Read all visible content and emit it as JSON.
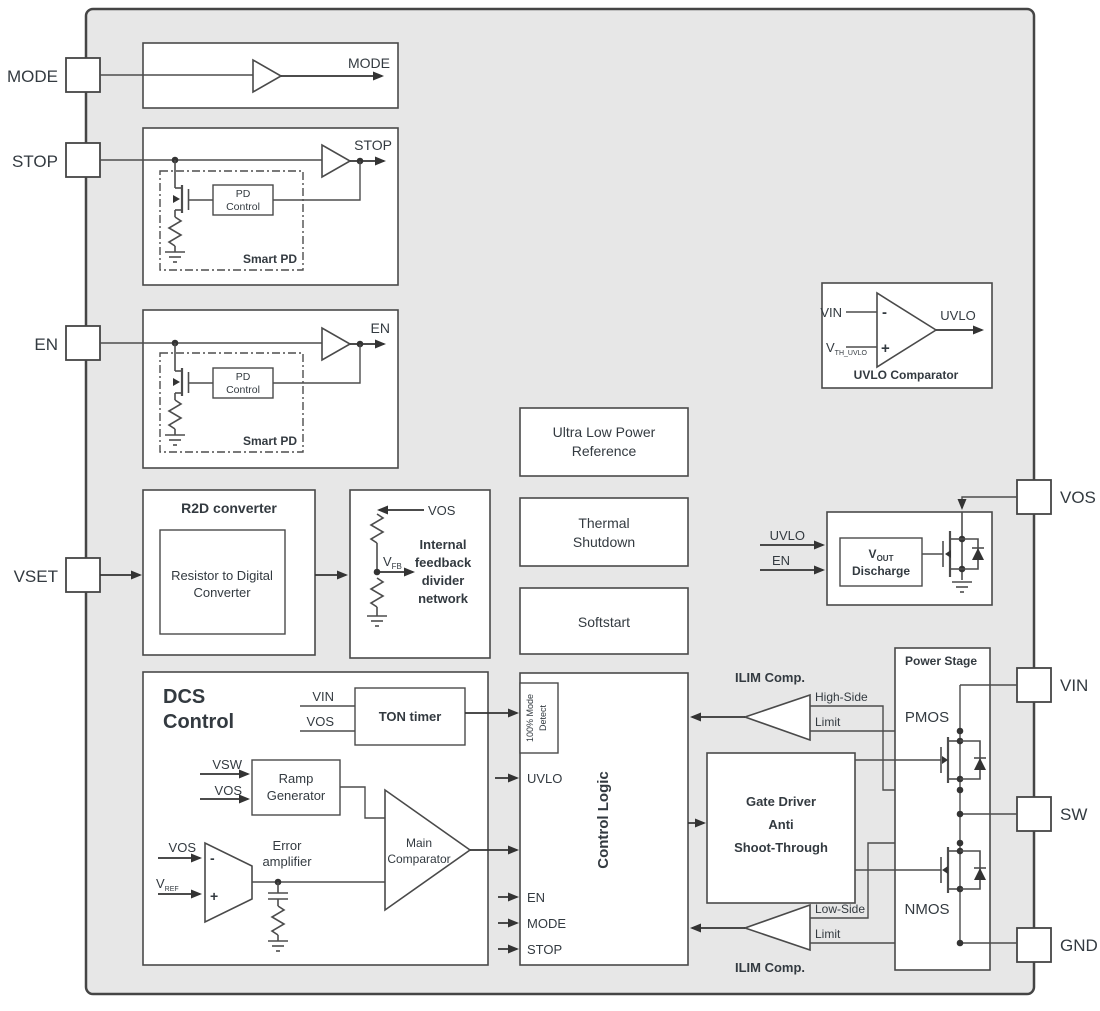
{
  "colors": {
    "chip_background": "#e7e7e7",
    "block_fill": "#ffffff",
    "line": "#4a4a4a",
    "text": "#333a40"
  },
  "pins": {
    "left": [
      "MODE",
      "STOP",
      "EN",
      "VSET"
    ],
    "right": [
      "VOS",
      "VIN",
      "SW",
      "GND"
    ]
  },
  "mode_block": {
    "output_label": "MODE"
  },
  "stop_block": {
    "output_label": "STOP",
    "pd_control_lines": [
      "PD",
      "Control"
    ],
    "smart_pd_label": "Smart PD"
  },
  "en_block": {
    "output_label": "EN",
    "pd_control_lines": [
      "PD",
      "Control"
    ],
    "smart_pd_label": "Smart PD"
  },
  "r2d_block": {
    "title": "R2D converter",
    "inner_lines": [
      "Resistor to Digital",
      "Converter"
    ]
  },
  "feedback_block": {
    "vos_label": "VOS",
    "vfb_base": "V",
    "vfb_sub": "FB",
    "label_lines": [
      "Internal",
      "feedback",
      "divider",
      "network"
    ]
  },
  "reference_block": {
    "lines": [
      "Ultra Low Power",
      "Reference"
    ]
  },
  "thermal_block": {
    "lines": [
      "Thermal",
      "Shutdown"
    ]
  },
  "softstart_block": {
    "label": "Softstart"
  },
  "uvlo_comparator": {
    "vin_label": "VIN",
    "vth_base": "V",
    "vth_sub": "TH_UVLO",
    "minus": "-",
    "plus": "+",
    "output_label": "UVLO",
    "title": "UVLO Comparator"
  },
  "discharge_block": {
    "uvlo_label": "UVLO",
    "en_label": "EN",
    "vout_base": "V",
    "vout_sub": "OUT",
    "line2": "Discharge"
  },
  "dcs_block": {
    "title_lines": [
      "DCS",
      "Control"
    ],
    "ton_timer": {
      "vin_label": "VIN",
      "vos_label": "VOS",
      "label": "TON timer"
    },
    "ramp_generator": {
      "vsw_label": "VSW",
      "vos_label": "VOS",
      "lines": [
        "Ramp",
        "Generator"
      ]
    },
    "error_amplifier": {
      "vos_label": "VOS",
      "vref_base": "V",
      "vref_sub": "REF",
      "minus": "-",
      "plus": "+",
      "lines": [
        "Error",
        "amplifier"
      ]
    },
    "main_comparator": {
      "lines": [
        "Main",
        "Comparator"
      ]
    }
  },
  "control_logic": {
    "title": "Control Logic",
    "mode_detect_lines": [
      "100% Mode",
      "Detect"
    ],
    "inputs": {
      "uvlo": "UVLO",
      "en": "EN",
      "mode": "MODE",
      "stop": "STOP"
    }
  },
  "gate_driver": {
    "lines": [
      "Gate Driver",
      "Anti",
      "Shoot-Through"
    ]
  },
  "ilim_high": {
    "title": "ILIM Comp.",
    "limit_lines": [
      "High-Side",
      "Limit"
    ]
  },
  "ilim_low": {
    "title": "ILIM Comp.",
    "limit_lines": [
      "Low-Side",
      "Limit"
    ]
  },
  "power_stage": {
    "title": "Power Stage",
    "pmos_label": "PMOS",
    "nmos_label": "NMOS"
  }
}
